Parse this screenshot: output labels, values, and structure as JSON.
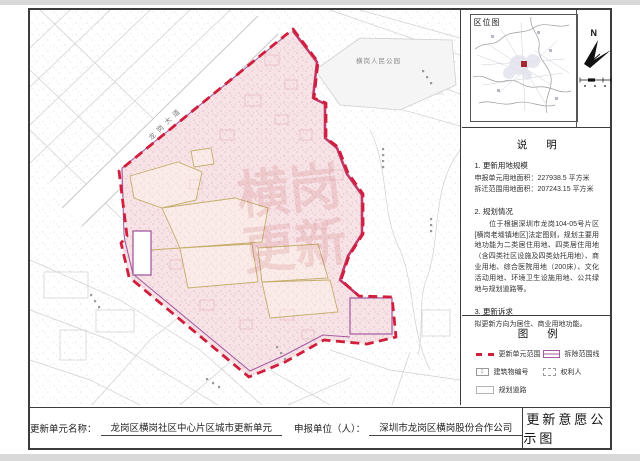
{
  "map": {
    "park_label": "横岗人民公园",
    "road_label": "龙岗大道",
    "watermark_line1": "横岗",
    "watermark_line2": "更新"
  },
  "location_panel": {
    "title": "区位图",
    "north_label": "N"
  },
  "notes_panel": {
    "title": "说  明",
    "sections": [
      {
        "heading": "1. 更新用地规模",
        "lines": [
          "申报单元用地面积：227938.5 平方米",
          "拆迁范围用地面积：207243.15 平方米"
        ]
      },
      {
        "heading": "2. 规划情况",
        "lines": [
          "　　位于根据深圳市龙岗104-05号片区[横岗老墟镇地区]法定图则，规划主要用地功能为二类居住用地、四类居住用地（含四类社区设施及四类幼托用地）、商业用地、综合医院用地（200床）、文化活动用地、环境卫生设施用地、公共绿地与规划道路等。"
        ]
      },
      {
        "heading": "3. 更新诉求",
        "lines": [
          "拟更新方向为居住、商业用地功能。"
        ]
      }
    ]
  },
  "legend_panel": {
    "title": "图  例",
    "items": [
      {
        "label": "更新单元范围",
        "swatch": "red-dash"
      },
      {
        "label": "拆除范围线",
        "swatch": "purple-line"
      },
      {
        "label": "建筑物编号",
        "swatch": "building-number"
      },
      {
        "label": "权利人",
        "swatch": "rights-holder"
      },
      {
        "label": "规划道路",
        "swatch": "planned-road"
      }
    ]
  },
  "footer": {
    "unit_name_label": "更新单元名称：",
    "unit_name": "龙岗区横岗社区中心片区城市更新单元",
    "applicant_label": "申报单位（人）：",
    "applicant": "深圳市龙岗区横岗股份合作公司",
    "sheet_title": "更新意愿公示图"
  },
  "colors": {
    "boundary_red": "#cf1f3c",
    "demolition_magenta": "#c23a6b",
    "parcel_purple": "#a45aa0",
    "area_pink": "#f7e2e6",
    "parcel_yellow": "#c4ae6a",
    "watermark_red": "#b5342e",
    "site_marker_red": "#a4282d"
  }
}
